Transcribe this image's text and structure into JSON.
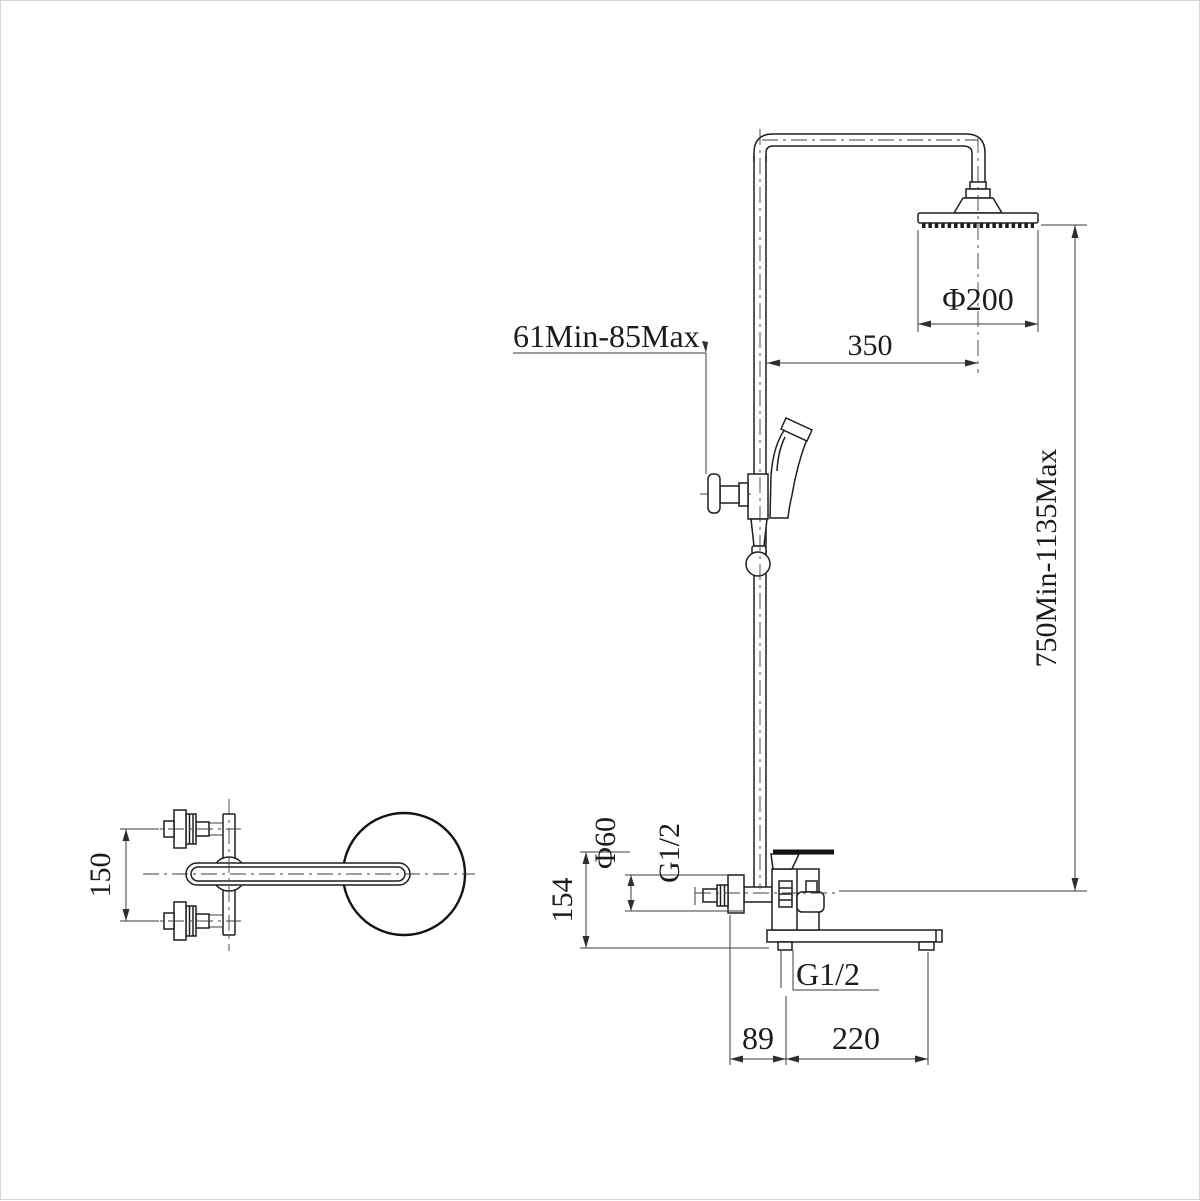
{
  "drawing_title": "shower-column-technical-drawing",
  "dims": {
    "head_diameter": "Φ200",
    "head_offset": "350",
    "slider_range": "61Min-85Max",
    "height_range": "750Min-1135Max",
    "flange_diameter": "Φ60",
    "shower_inlet_thread": "G1/2",
    "bottom_outlet_thread": "G1/2",
    "faucet_height": "154",
    "inlet_spacing": "150",
    "spout_back_offset": "89",
    "spout_reach": "220"
  },
  "colors": {
    "line": "#1f1f1f",
    "dimension": "#3c3c3c",
    "background": "#ffffff"
  }
}
